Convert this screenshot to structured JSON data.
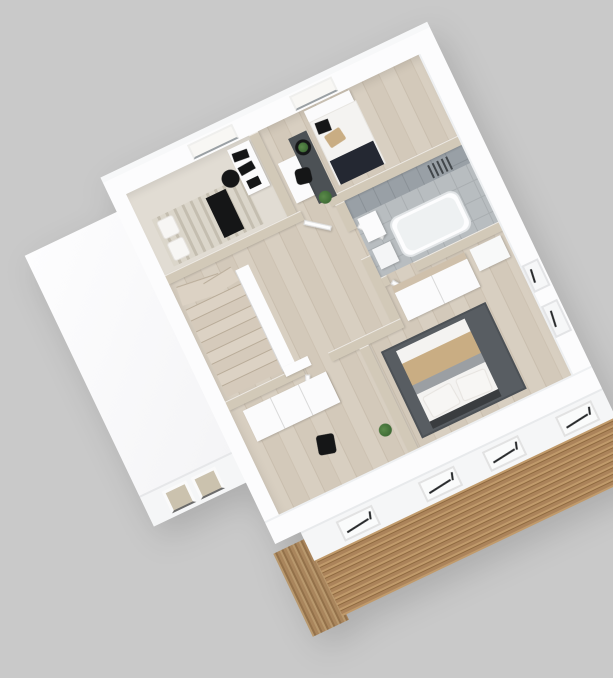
{
  "palette": {
    "bg": "#c9c9c9",
    "wall-white": "#fcfcfd",
    "wall-cap-beige": "#d2c9b8",
    "facade-white": "#f5f6f7",
    "floor-wood": "#d8cfc1",
    "floor-wood-dark": "#c9beae",
    "study-floor": "#e1dcd3",
    "tile-wall": "#99a0a6",
    "tile-wall-line": "#8a9197",
    "tile-floor": "#b8bdc0",
    "tile-floor-line": "#a9aeb1",
    "tub-inner": "#eef1f2",
    "rug-dark": "#585d62",
    "rug-runner": "#4c5155",
    "duvet-white": "#f4f3f1",
    "blanket-tan": "#c9ad83",
    "blanket-gray": "#9b9fa3",
    "throw-navy": "#242832",
    "black-furniture": "#151617",
    "plant-green": "#3e6b35",
    "bed-beige": "#cfc8b9",
    "slat-light": "#c09a6b",
    "slat-mid": "#ab835a",
    "slat-dark": "#8f6a40",
    "grain-light": "#b8986d",
    "grain-dark": "#93714a",
    "glass-beige": "#cbc2ae",
    "glass-bright": "#f8f7f4",
    "sash-black": "#26282a",
    "door-white": "#fdfdfd",
    "radiator-dark": "#42474b",
    "tread-light": "#dcd2c4",
    "tread-dark": "#d5cabb",
    "tread-edge": "#b9ac99"
  },
  "scene": {
    "type": "3d-floor-plan-render",
    "view": "isometric-top",
    "rotation_deg": -25.5,
    "stairs": {
      "tread_count": 8
    },
    "rooms": [
      {
        "id": "study-bedroom",
        "furniture": [
          "bed-beige",
          "pillows",
          "black-throw",
          "desk",
          "monitor",
          "monitor",
          "office-chair",
          "window"
        ]
      },
      {
        "id": "single-room",
        "furniture": [
          "daybed",
          "navy-throw",
          "beige-pillow",
          "black-cushion",
          "headboard-shelf",
          "runner-rug",
          "round-table",
          "plant",
          "desk",
          "office-chair",
          "floor-plant",
          "window"
        ]
      },
      {
        "id": "bathroom",
        "furniture": [
          "bathtub",
          "cabinet",
          "cabinet",
          "radiator",
          "tiled-wall",
          "tiled-floor"
        ]
      },
      {
        "id": "hallway",
        "furniture": [
          "staircase",
          "parapet-wall",
          "doors"
        ]
      },
      {
        "id": "bottom-room",
        "furniture": [
          "wardrobe",
          "chair",
          "plant",
          "window"
        ]
      },
      {
        "id": "master-bedroom",
        "furniture": [
          "wardrobe-wood-top",
          "dresser",
          "double-bed",
          "pillows",
          "tan-blanket",
          "gray-blanket",
          "dark-rug",
          "windows"
        ]
      }
    ],
    "exterior": {
      "garage": {
        "windows": 2
      },
      "se_facade_windows": 4,
      "ne_wall_windows": 2,
      "nw_wall_windows": 2,
      "ground_floor_cladding": "horizontal-wood-slats"
    }
  }
}
